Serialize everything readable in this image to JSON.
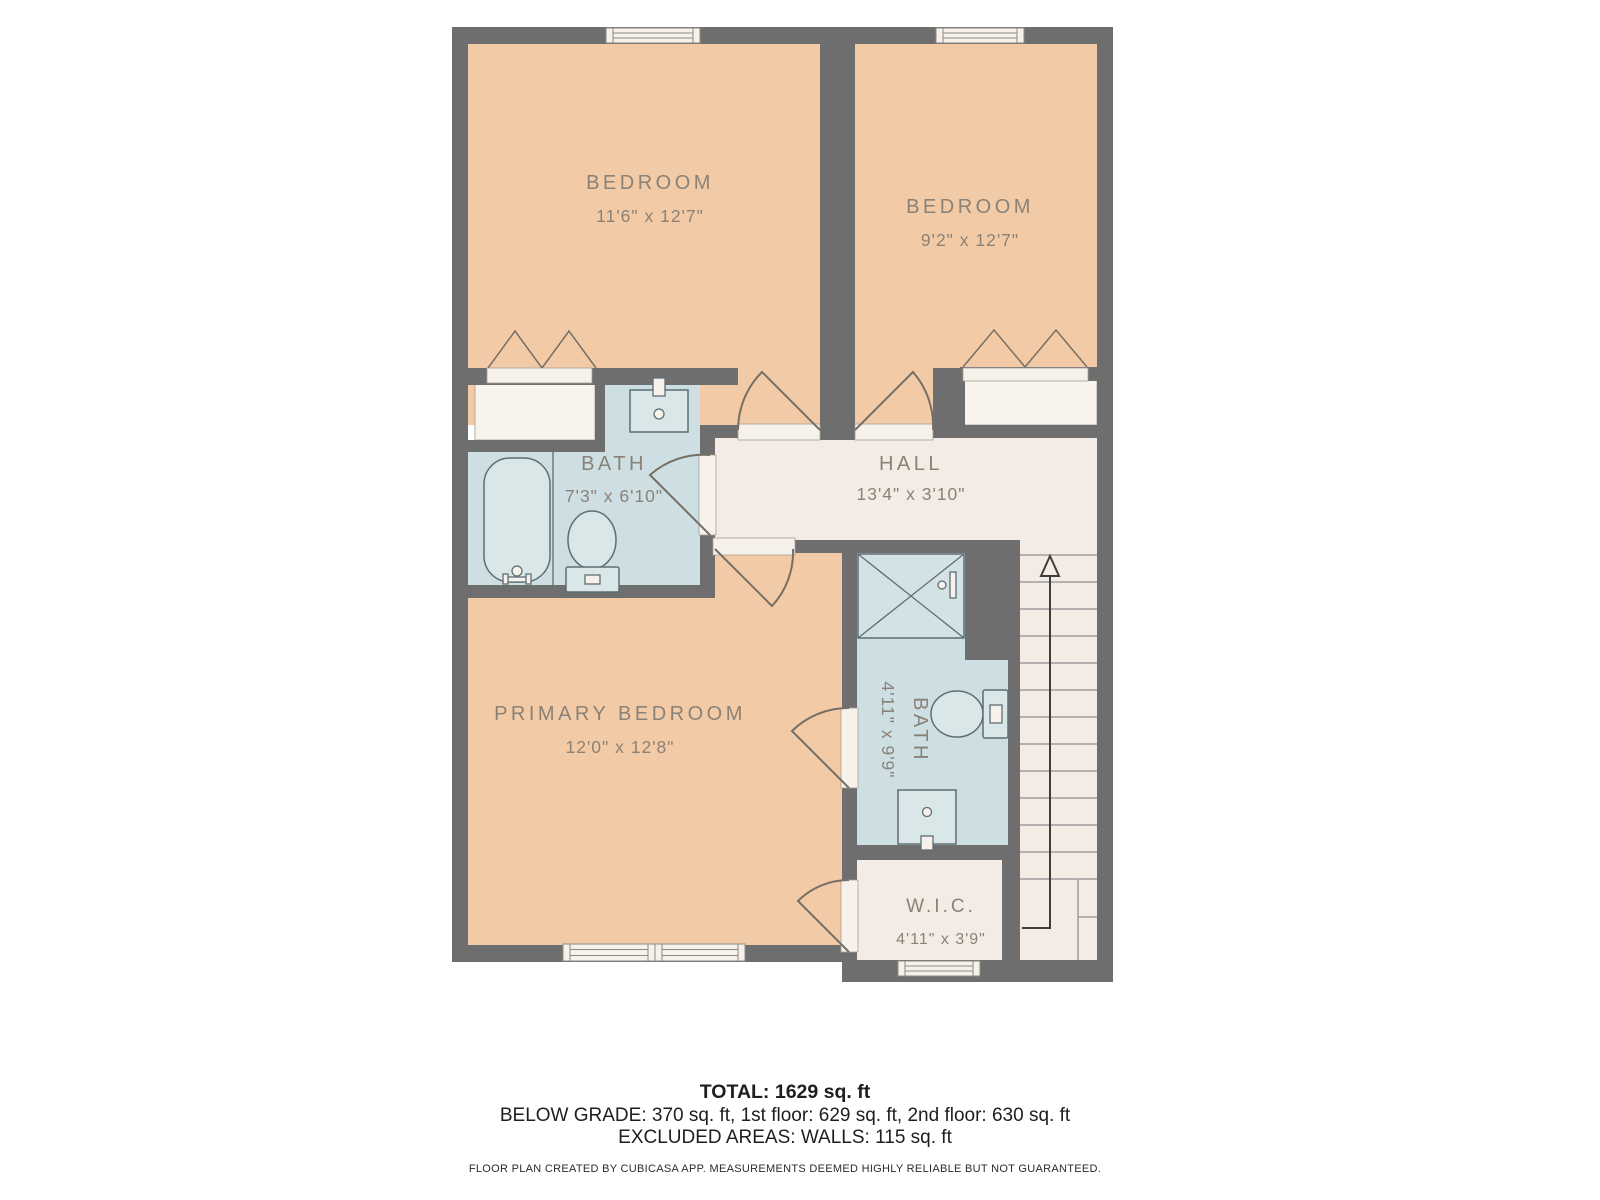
{
  "document_type": "floor-plan",
  "rooms": [
    {
      "id": "bedroom-1",
      "name": "BEDROOM",
      "dims": "11'6\" x 12'7\""
    },
    {
      "id": "bedroom-2",
      "name": "BEDROOM",
      "dims": "9'2\" x 12'7\""
    },
    {
      "id": "bath-1",
      "name": "BATH",
      "dims": "7'3\" x 6'10\""
    },
    {
      "id": "hall",
      "name": "HALL",
      "dims": "13'4\" x 3'10\""
    },
    {
      "id": "primary-bedroom",
      "name": "PRIMARY BEDROOM",
      "dims": "12'0\" x 12'8\""
    },
    {
      "id": "bath-2",
      "name": "BATH",
      "dims": "4'11\" x 9'9\""
    },
    {
      "id": "wic",
      "name": "W.I.C.",
      "dims": "4'11\" x 3'9\""
    }
  ],
  "summary": {
    "total": "TOTAL: 1629 sq. ft",
    "floors": "BELOW GRADE: 370 sq. ft, 1st floor: 629 sq. ft, 2nd floor: 630 sq. ft",
    "excluded": "EXCLUDED AREAS: WALLS: 115 sq. ft"
  },
  "disclaimer": "FLOOR PLAN CREATED BY CUBICASA APP. MEASUREMENTS DEEMED HIGHLY RELIABLE BUT NOT GUARANTEED.",
  "icons": [
    "window-icon",
    "door-swing-icon",
    "bifold-closet-icon",
    "bathtub-icon",
    "toilet-icon",
    "sink-icon",
    "shower-icon",
    "stairs-up-arrow-icon"
  ],
  "colors": {
    "wall": "#6e6e6e",
    "bedroom_floor": "#f2cba6",
    "bath_floor": "#cddfe2",
    "hall_floor": "#f4ebe4",
    "closet_floor": "#f8f3ed",
    "window_fill": "#f6f1eb",
    "fixture_outline": "#5d6e74",
    "label_text": "#8a8177",
    "footer_text": "#1e1e1e",
    "stairs_arrow": "#3d3d3d"
  }
}
